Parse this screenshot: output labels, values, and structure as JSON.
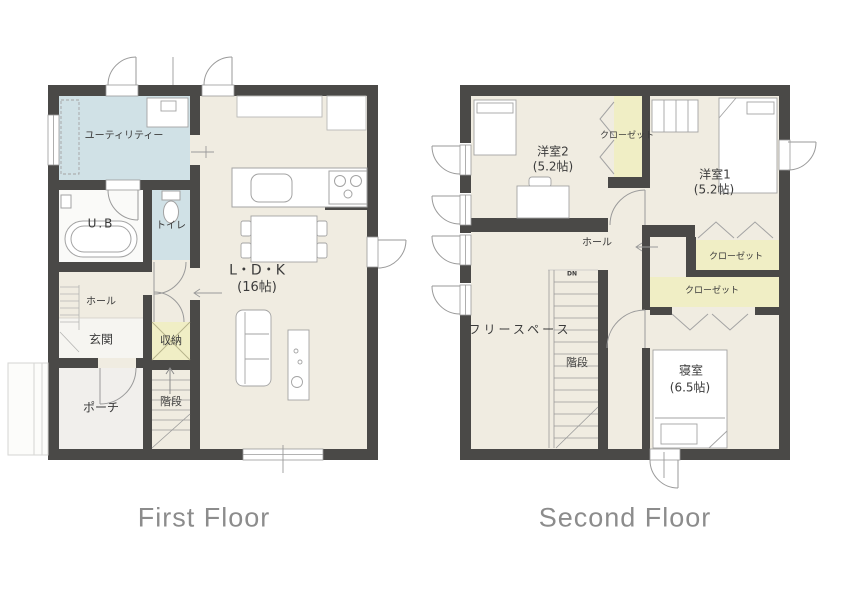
{
  "title": "Floor plan",
  "colors": {
    "wall": "#4a4947",
    "floor": "#f0ece1",
    "water_rooms": "#d0e1e6",
    "closet_fill": "#f0eec5",
    "porch_fill": "#f1efec",
    "entrance_fill": "#f6f5f1",
    "bath_fill": "#fafaf8",
    "caption_text": "#8c8c8c",
    "label_text": "#3b3b3b"
  },
  "floors": [
    {
      "caption": "First Floor",
      "rooms": {
        "utility": {
          "label": "ユーティリティー"
        },
        "bath": {
          "label": "U.B"
        },
        "toilet": {
          "label": "トイレ"
        },
        "hall": {
          "label": "ホール"
        },
        "entrance": {
          "label": "玄関"
        },
        "storage": {
          "label": "収納"
        },
        "porch": {
          "label": "ポーチ"
        },
        "stairs": {
          "label": "階段"
        },
        "ldk": {
          "label": "L・D・K",
          "size": "(16帖)"
        }
      }
    },
    {
      "caption": "Second Floor",
      "rooms": {
        "western_room_2": {
          "label": "洋室2",
          "size": "(5.2帖)"
        },
        "western_room_1": {
          "label": "洋室1",
          "size": "(5.2帖)"
        },
        "closet_top": {
          "label": "クローゼット"
        },
        "closet_mid": {
          "label": "クローゼット"
        },
        "closet_lower": {
          "label": "クローゼット"
        },
        "hall": {
          "label": "ホール"
        },
        "free_space": {
          "label": "フリースペース"
        },
        "stairs": {
          "label": "階段",
          "direction": "DN"
        },
        "bedroom": {
          "label": "寝室",
          "size": "(6.5帖)"
        }
      }
    }
  ]
}
